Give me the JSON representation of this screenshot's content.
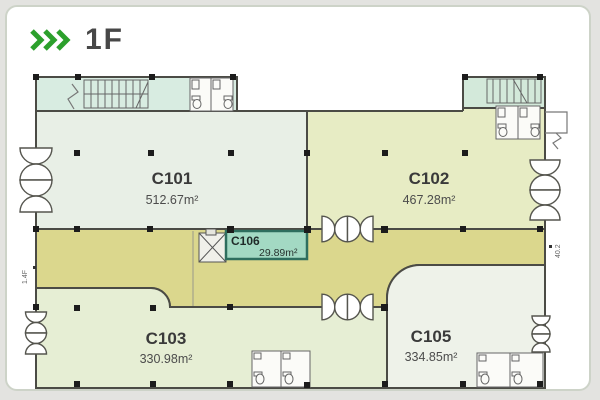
{
  "header": {
    "chevrons": "»»»",
    "title": "1F"
  },
  "plan": {
    "units": [
      {
        "id": "C101",
        "area": "512.67m²"
      },
      {
        "id": "C102",
        "area": "467.28m²"
      },
      {
        "id": "C103",
        "area": "330.98m²"
      },
      {
        "id": "C105",
        "area": "334.85m²"
      },
      {
        "id": "C106",
        "area": "29.89m²",
        "highlighted": true
      }
    ],
    "annotations": {
      "left_wall": "1.4F",
      "right_wall": "40.2"
    },
    "colors": {
      "accent_green": "#2ca02c",
      "wall": "#4b4b45",
      "unit_c101": "#e8efe6",
      "unit_c102": "#e7ecc4",
      "unit_c103": "#e6eed4",
      "unit_c105": "#eef2e9",
      "corridor": "#dbd78d",
      "lobby_strip": "#d8ece1",
      "highlight_fill": "#a3d9c3",
      "highlight_border": "#2e6e5e"
    }
  }
}
